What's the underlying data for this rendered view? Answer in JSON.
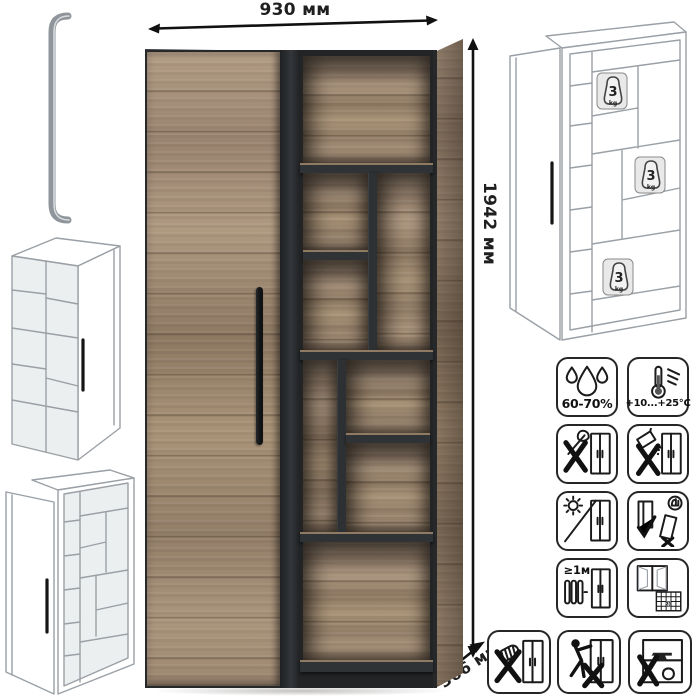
{
  "dimensions": {
    "width_label": "930 мм",
    "height_label": "1942 мм",
    "depth_label": "366 мм"
  },
  "weight_badge": {
    "value": "3",
    "unit": "kg"
  },
  "care_icons": {
    "humidity": {
      "icon": "water-drops-icon",
      "label": "60-70%"
    },
    "temperature": {
      "icon": "thermometer-icon",
      "label": "+10...+25°C"
    },
    "no_sharp_tools": {
      "icon": "no-sharp-tools-icon"
    },
    "no_spill": {
      "icon": "no-spill-icon"
    },
    "no_sunlight": {
      "icon": "no-direct-sunlight-icon"
    },
    "keep_upright": {
      "icon": "transport-upright-icon"
    },
    "heat_distance": {
      "icon": "heater-distance-icon",
      "label": "≥1м"
    },
    "ventilation": {
      "icon": "ventilate-room-icon",
      "label": "21"
    },
    "no_abrasive": {
      "icon": "no-abrasive-cleaners-icon"
    },
    "no_drag": {
      "icon": "do-not-drag-icon"
    },
    "no_overload": {
      "icon": "do-not-overload-icon"
    }
  },
  "colors": {
    "wood": "#a6907a",
    "carcass_dark": "#303335",
    "outline": "#1b1b1b",
    "wireframe_line": "#9aa0a5",
    "background": "#ffffff"
  }
}
